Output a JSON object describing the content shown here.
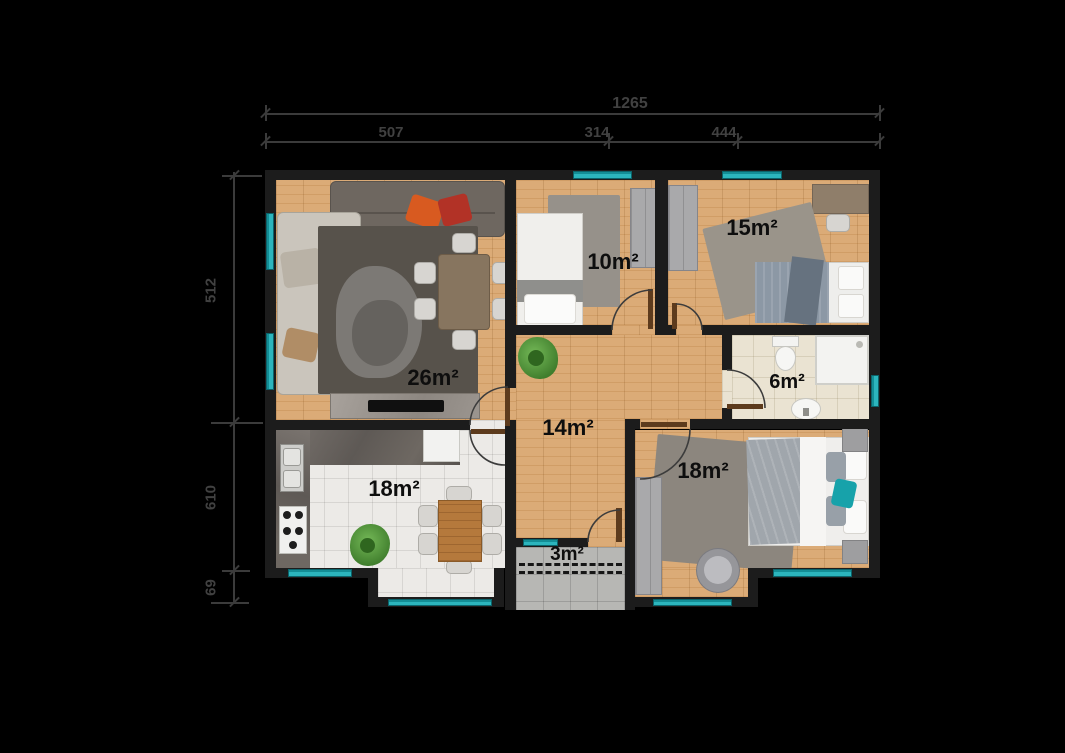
{
  "scene": "apartment-floor-plan",
  "dimensions": {
    "total_width": "1265",
    "segments_top": [
      "507",
      "314",
      "444"
    ],
    "segments_left": [
      "512",
      "610",
      "69"
    ]
  },
  "rooms": {
    "living": {
      "label": "26m²"
    },
    "bedroom_10": {
      "label": "10m²"
    },
    "bedroom_15": {
      "label": "15m²"
    },
    "bathroom": {
      "label": "6m²"
    },
    "hallway": {
      "label": "14m²"
    },
    "kitchen": {
      "label": "18m²"
    },
    "entry": {
      "label": "3m²"
    },
    "bedroom_18": {
      "label": "18m²"
    }
  },
  "colors": {
    "background": "#000000",
    "walls": "#1c1c1c",
    "window_teal": "#1aa5ae",
    "wood_floor": "#d9a770",
    "dimension_text": "#414141",
    "accent_pillow": "#17a2aa"
  }
}
